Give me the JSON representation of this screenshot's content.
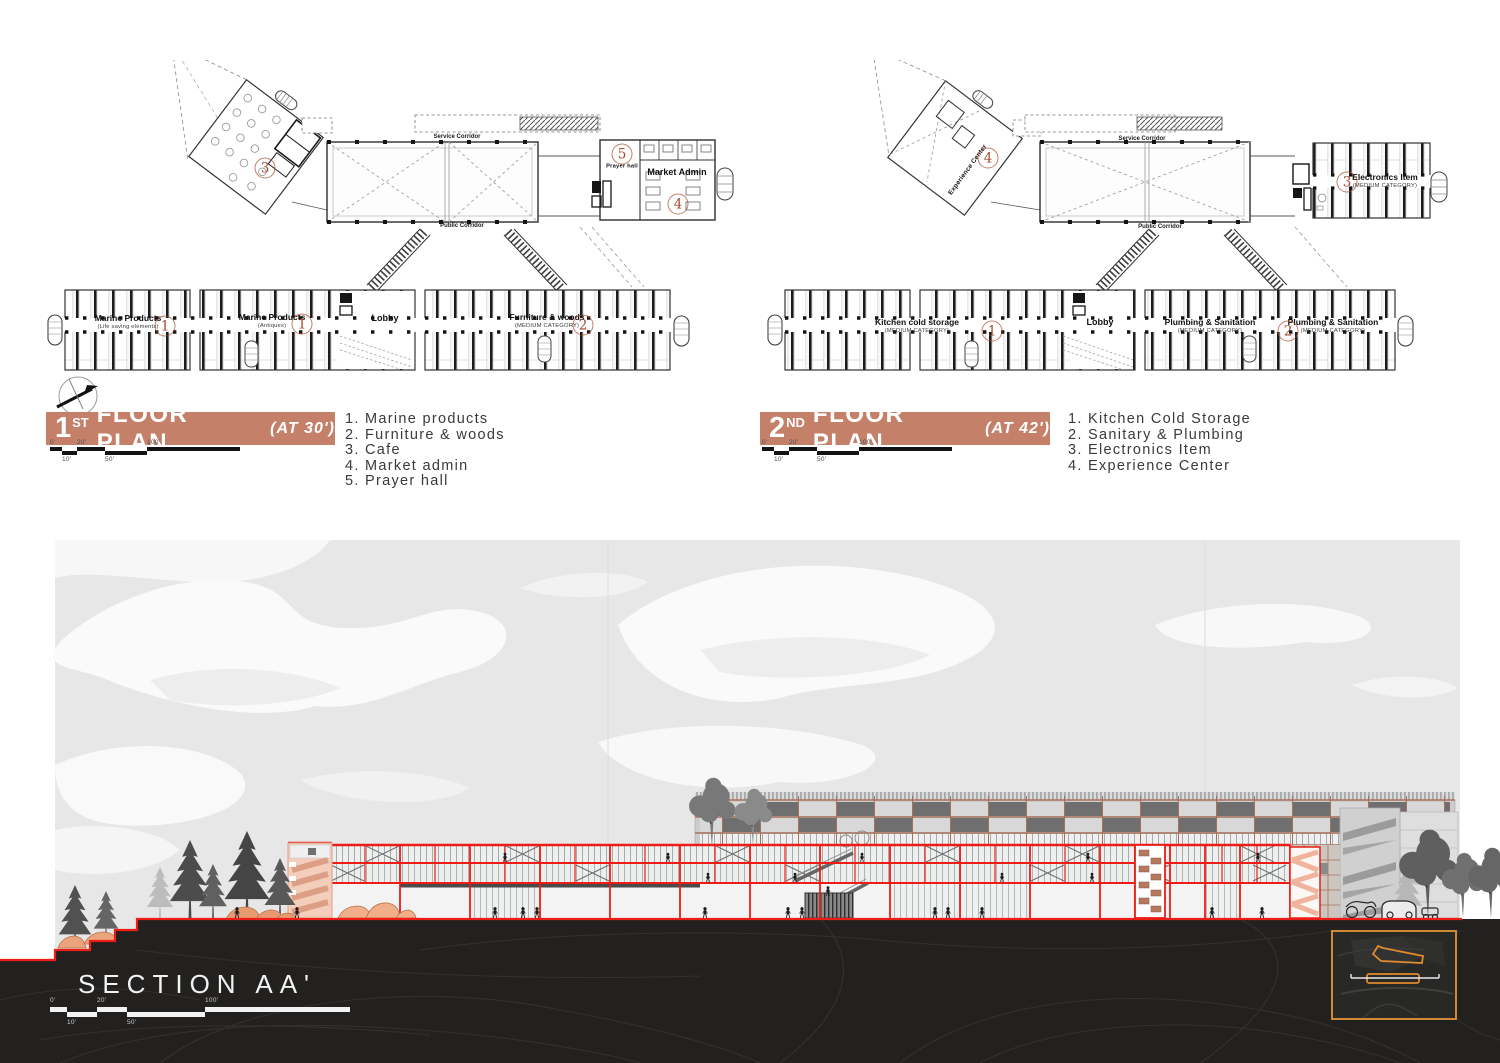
{
  "plan1": {
    "title": {
      "num": "1",
      "sup": "ST",
      "rest": "FLOOR PLAN",
      "at": "(AT 30')"
    },
    "scale": {
      "t0": "0'",
      "t20": "20'",
      "t100": "100'",
      "b10": "10'",
      "b50": "50'"
    },
    "legend": [
      "1. Marine products",
      "2. Furniture & woods",
      "3. Cafe",
      "4. Market admin",
      "5. Prayer hall"
    ],
    "labels": {
      "service_corridor": "Service Corridor",
      "public_corridor": "Public Corridor",
      "marine1_name": "Marine Products",
      "marine1_sub": "(Life saving elements)",
      "marine1_num": "1",
      "marine2_name": "Marine Products",
      "marine2_sub": "(Antiques)",
      "marine2_num": "1",
      "lobby": "Lobby",
      "furniture_name": "Furniture & woods",
      "furniture_sub": "(MEDIUM CATEGORY)",
      "furniture_num": "2",
      "market_admin": "Market Admin",
      "market_admin_num": "4",
      "prayer_name": "Prayer hall",
      "prayer_num": "5",
      "cafe_num": "3"
    }
  },
  "plan2": {
    "title": {
      "num": "2",
      "sup": "ND",
      "rest": "FLOOR PLAN",
      "at": "(AT 42')"
    },
    "scale": {
      "t0": "0'",
      "t20": "20'",
      "t100": "100'",
      "b10": "10'",
      "b50": "50'"
    },
    "legend": [
      "1. Kitchen Cold Storage",
      "2. Sanitary & Plumbing",
      "3. Electronics Item",
      "4. Experience Center"
    ],
    "labels": {
      "service_corridor": "Service Corridor",
      "public_corridor": "Public Corridor",
      "kitchen_name": "Kitchen cold storage",
      "kitchen_sub": "(MEDIUM CATEGORY)",
      "kitchen_num": "1",
      "lobby": "Lobby",
      "plumbing1_name": "Plumbing & Sanitation",
      "plumbing1_sub": "(MEDIUM CATEGORY)",
      "plumbing_num": "2",
      "plumbing2_name": "Plumbing & Sanitation",
      "plumbing2_sub": "(MEDIUM CATEGORY)",
      "electronics_name": "Electronics Item",
      "electronics_sub": "(MEDIUM CATEGORY)",
      "electronics_num": "3",
      "experience_name": "Experience Center",
      "experience_num": "4"
    }
  },
  "section": {
    "title": "SECTION AA'",
    "scale": {
      "t0": "0'",
      "t20": "20'",
      "t100": "100'",
      "b10": "10'",
      "b50": "50'"
    }
  },
  "colors": {
    "accent_bar": "#C5806A",
    "number": "#A7492C",
    "section_red": "#ED1C16",
    "key_border": "#CF8A33"
  }
}
